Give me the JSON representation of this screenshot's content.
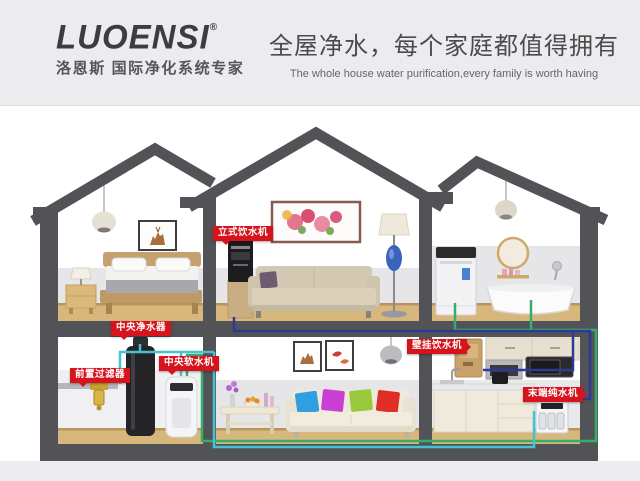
{
  "header": {
    "brand": {
      "logo": "LUOENSI",
      "registered": "®",
      "tagline": "洛恩斯 国际净化系统专家"
    },
    "slogan_cn": "全屋净水，每个家庭都值得拥有",
    "slogan_en": "The whole house water purification,every family is worth having"
  },
  "equipment_labels": {
    "standing_dispenser": "立式饮水机",
    "central_purifier": "中央净水器",
    "pre_filter": "前置过滤器",
    "central_softener": "中央软水机",
    "wall_dispenser": "壁挂饮水机",
    "terminal_purifier": "末端纯水机"
  },
  "colors": {
    "label_red": "#d6141e",
    "structure_gray": "#525356",
    "pipe_cyan": "#44c3d4",
    "pipe_green": "#35ae6b",
    "pipe_blue": "#2c3a96",
    "wood_floor": "#d8b77d",
    "header_bg": "#ececee"
  }
}
